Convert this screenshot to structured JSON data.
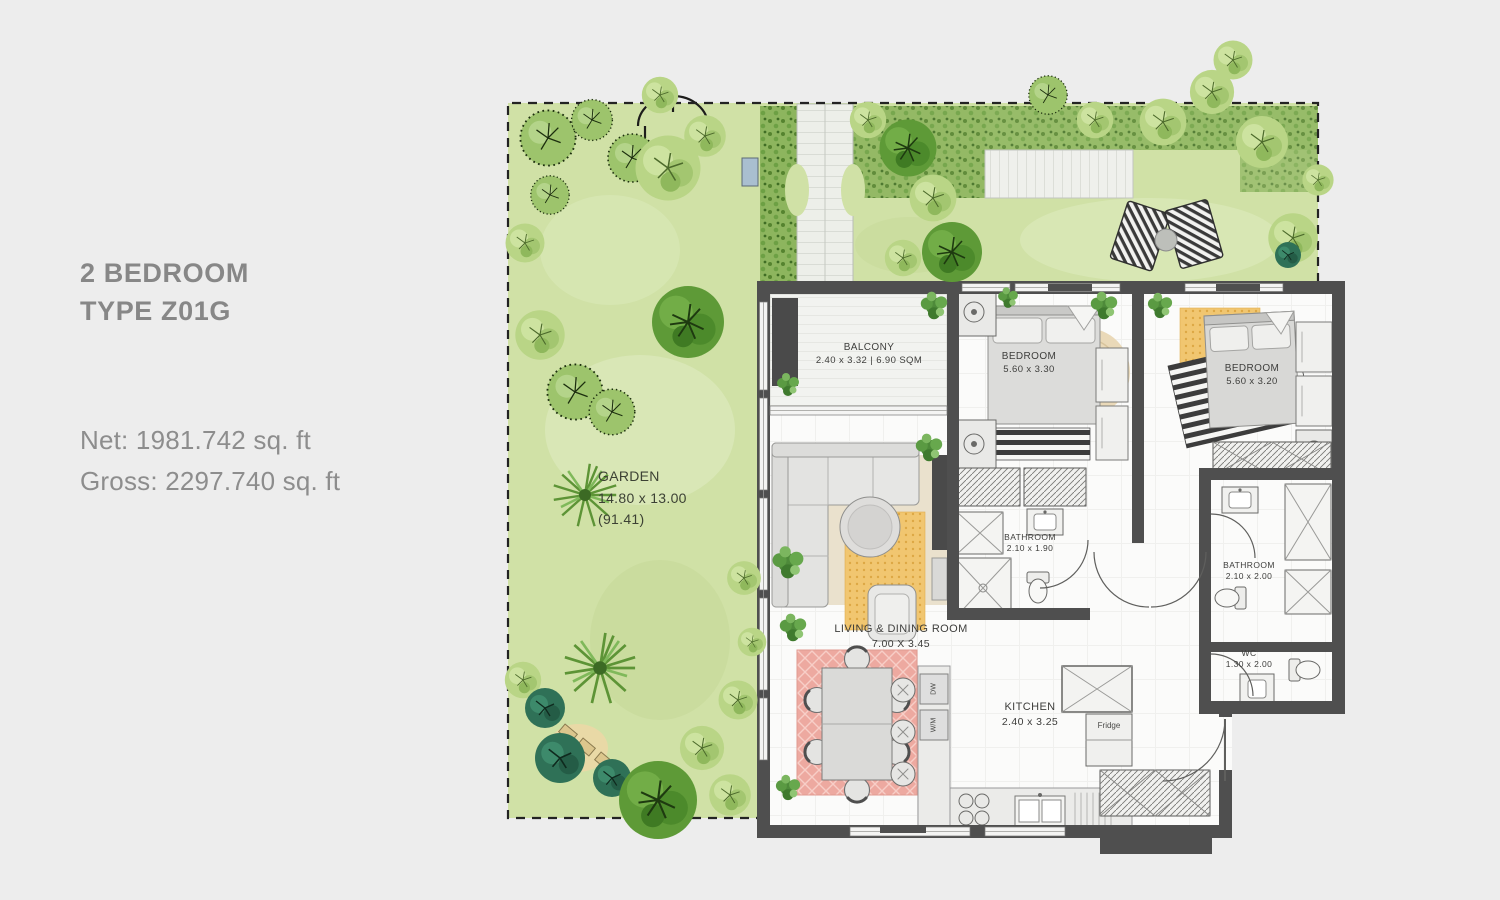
{
  "info": {
    "title_line1": "2 BEDROOM",
    "title_line2": "TYPE Z01G",
    "net_label": "Net: 1981.742 sq. ft",
    "gross_label": "Gross: 2297.740 sq. ft"
  },
  "garden_label": {
    "name": "GARDEN",
    "dims": "14.80 x 13.00",
    "area": "(91.41)"
  },
  "rooms": {
    "balcony": {
      "name": "BALCONY",
      "dims": "2.40 x 3.32 | 6.90 SQM"
    },
    "bedroom1": {
      "name": "BEDROOM",
      "dims": "5.60 x 3.30"
    },
    "bedroom2": {
      "name": "BEDROOM",
      "dims": "5.60 x 3.20"
    },
    "bathroom1": {
      "name": "BATHROOM",
      "dims": "2.10 x 1.90"
    },
    "bathroom2": {
      "name": "BATHROOM",
      "dims": "2.10 x 2.00"
    },
    "wc": {
      "name": "WC",
      "dims": "1.30 x 2.00"
    },
    "living": {
      "name": "LIVING & DINING ROOM",
      "dims": "7.00 X 3.45"
    },
    "kitchen": {
      "name": "KITCHEN",
      "dims": "2.40 x 3.25"
    }
  },
  "appliances": {
    "fridge": "Fridge",
    "dishwasher": "DW",
    "washing_machine": "W/M"
  },
  "colors": {
    "page_background": "#ededed",
    "wall": "#4f4f4f",
    "lawn_green": "#d4e4ab",
    "bed_foliage_green": "#8db55e",
    "rug_red": "#eda9a0",
    "rug_yellow": "#f1c670",
    "rug_jute": "#ead9b8",
    "text_gray": "#878787"
  }
}
